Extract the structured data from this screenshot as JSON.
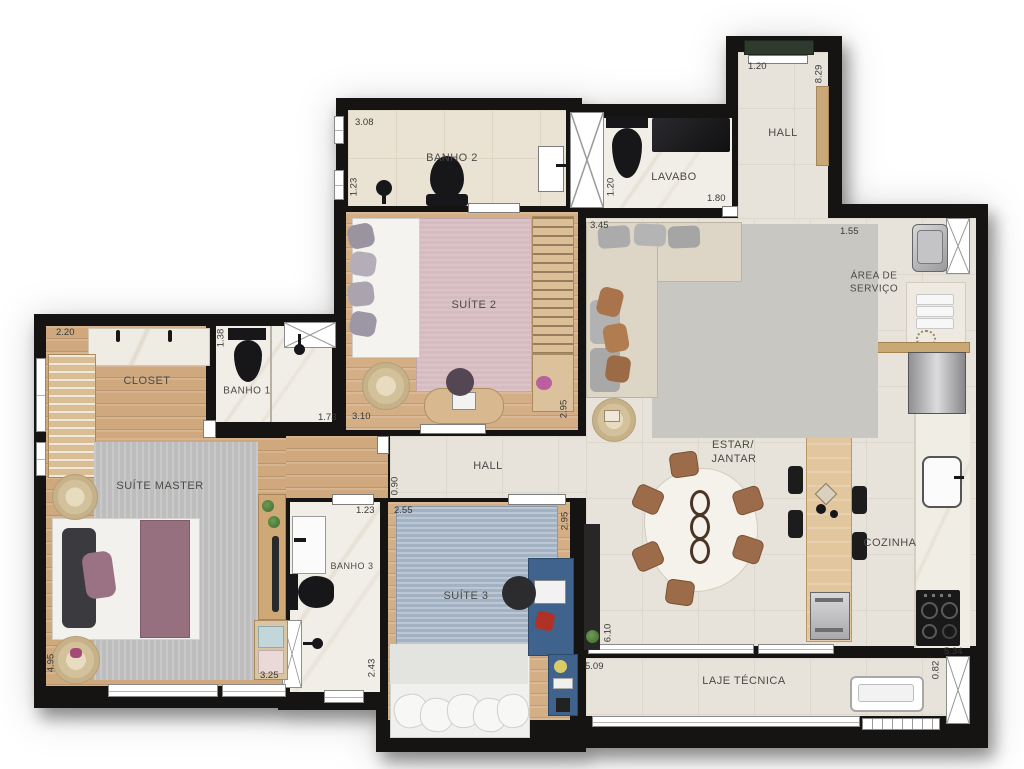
{
  "plan": {
    "type": "apartment-floor-plan",
    "wall_color": "#161412",
    "rooms": {
      "banho2": {
        "label": "BANHO 2",
        "dim_top": "3.08",
        "dim_left": "1.23"
      },
      "lavabo": {
        "label": "LAVABO",
        "dim_left": "1.20",
        "dim_bottom": "1.80"
      },
      "hall_entry": {
        "label": "HALL",
        "dim_top": "1.20",
        "dim_right": "8.29"
      },
      "area_servico": {
        "label_line1": "ÁREA DE",
        "label_line2": "SERVIÇO",
        "dim_top": "1.55"
      },
      "suite2": {
        "label": "SUÍTE 2",
        "dim_bottom": "3.10",
        "dim_right": "2.95"
      },
      "closet": {
        "label": "CLOSET",
        "dim_top": "2.20"
      },
      "banho1": {
        "label": "BANHO 1",
        "dim_left": "1.38",
        "dim_bottom": "1.73"
      },
      "suite_master": {
        "label": "SUÍTE MASTER",
        "dim_left": "4.95",
        "dim_bottom": "3.25"
      },
      "hall": {
        "label": "HALL",
        "dim_left": "0.90"
      },
      "banho3": {
        "label": "BANHO 3",
        "dim_top": "1.23",
        "dim_right": "2.43"
      },
      "suite3": {
        "label": "SUÍTE 3",
        "dim_top": "2.55",
        "dim_right": "2.95"
      },
      "estar_jantar": {
        "label_line1": "ESTAR/",
        "label_line2": "JANTAR",
        "dim_top": "3.45",
        "dim_left": "6.10"
      },
      "cozinha": {
        "label": "COZINHA",
        "dim_bottom": "5.34"
      },
      "laje_tecnica": {
        "label": "LAJE TÉCNICA",
        "dim_left": "5.09",
        "dim_right": "0.82"
      }
    }
  }
}
